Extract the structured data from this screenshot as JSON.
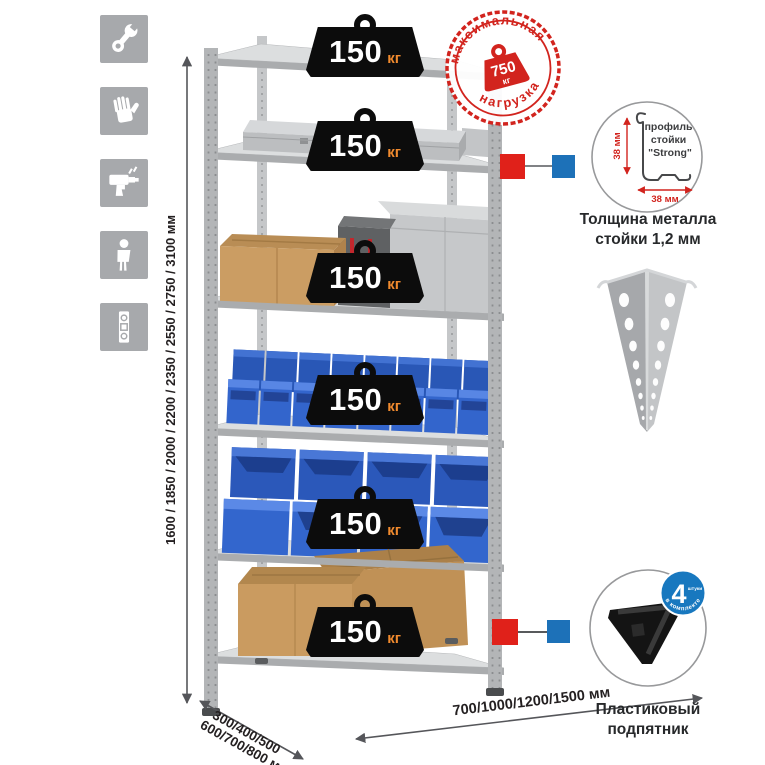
{
  "canvas": {
    "width": 765,
    "height": 765,
    "background": "#ffffff"
  },
  "left_icons": {
    "tile_color": "#a7a9ac",
    "items": [
      {
        "name": "wrench-icon"
      },
      {
        "name": "gloves-icon"
      },
      {
        "name": "drill-icon"
      },
      {
        "name": "person-icon"
      },
      {
        "name": "level-icon"
      }
    ]
  },
  "dimensions": {
    "height_label": "1600 / 1850 / 2000 / 2200 / 2350 / 2550 / 2750 / 3100 мм",
    "depth_label_line1": "300/400/500",
    "depth_label_line2": "600/700/800 мм",
    "width_label": "700/1000/1200/1500 мм"
  },
  "rack": {
    "shelf_loads": [
      {
        "value": "150",
        "unit": "кг"
      },
      {
        "value": "150",
        "unit": "кг"
      },
      {
        "value": "150",
        "unit": "кг"
      },
      {
        "value": "150",
        "unit": "кг"
      },
      {
        "value": "150",
        "unit": "кг"
      },
      {
        "value": "150",
        "unit": "кг"
      }
    ]
  },
  "max_load_stamp": {
    "arc_top": "максимальная",
    "arc_bottom": "нагрузка",
    "value": "750",
    "unit": "кг",
    "color": "#d2241e"
  },
  "profile_detail": {
    "label_line1": "профиль",
    "label_line2": "стойки",
    "label_line3": "\"Strong\"",
    "dim_vertical": "38 мм",
    "dim_horizontal": "38 мм",
    "caption_line1": "Толщина металла",
    "caption_line2": "стойки 1,2 мм"
  },
  "foot_detail": {
    "badge_value": "4",
    "badge_qty_word": "штуки",
    "badge_arc": "в комплекте",
    "caption_line1": "Пластиковый",
    "caption_line2": "подпятник"
  },
  "colors": {
    "accent_red": "#d2241e",
    "connector_red": "#e0211a",
    "connector_blue": "#1d71b8",
    "badge_blue": "#1878bf",
    "bin_blue": "#3365cc",
    "weight_black": "#0c0c0c",
    "weight_unit_orange": "#f08a2e",
    "metal_gray": "#c6c8ca",
    "icon_tile_gray": "#a7a9ac"
  }
}
